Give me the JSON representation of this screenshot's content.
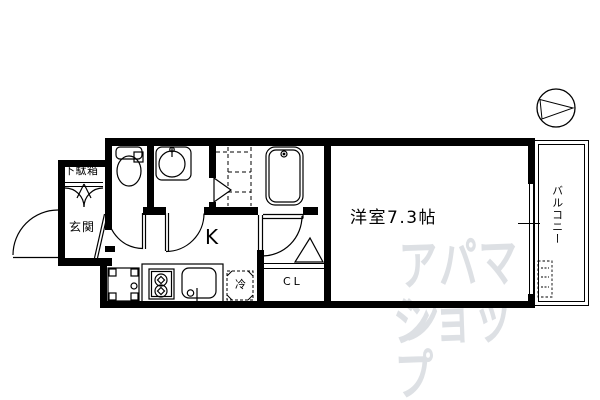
{
  "page": {
    "background_color": "#ffffff",
    "line_color": "#000000",
    "watermark_color": "#dde0e4"
  },
  "floor_plan": {
    "labels": {
      "shoe_cabinet": "下駄箱",
      "entrance": "玄関",
      "kitchen": "K",
      "main_room": "洋室7.3帖",
      "closet": "CL",
      "refrigerator": "冷",
      "balcony": "バルコニー"
    },
    "icons": {
      "north_arrow": "circle-with-right-triangle",
      "toilet": "tank-and-bowl",
      "washbasin": "round-basin-with-faucet",
      "bathtub": "double-outline-tub-with-drain",
      "stove": "two-burner-circles",
      "kitchen_sink": "rounded-rect-with-faucet",
      "washing_machine_pan": "square-with-corner-tabs-and-drain",
      "refrigerator_space": "dashed-square",
      "meter_box": "small-dashed-rect"
    }
  },
  "watermark": {
    "line1": "アパマン",
    "line2": "ショップ"
  }
}
